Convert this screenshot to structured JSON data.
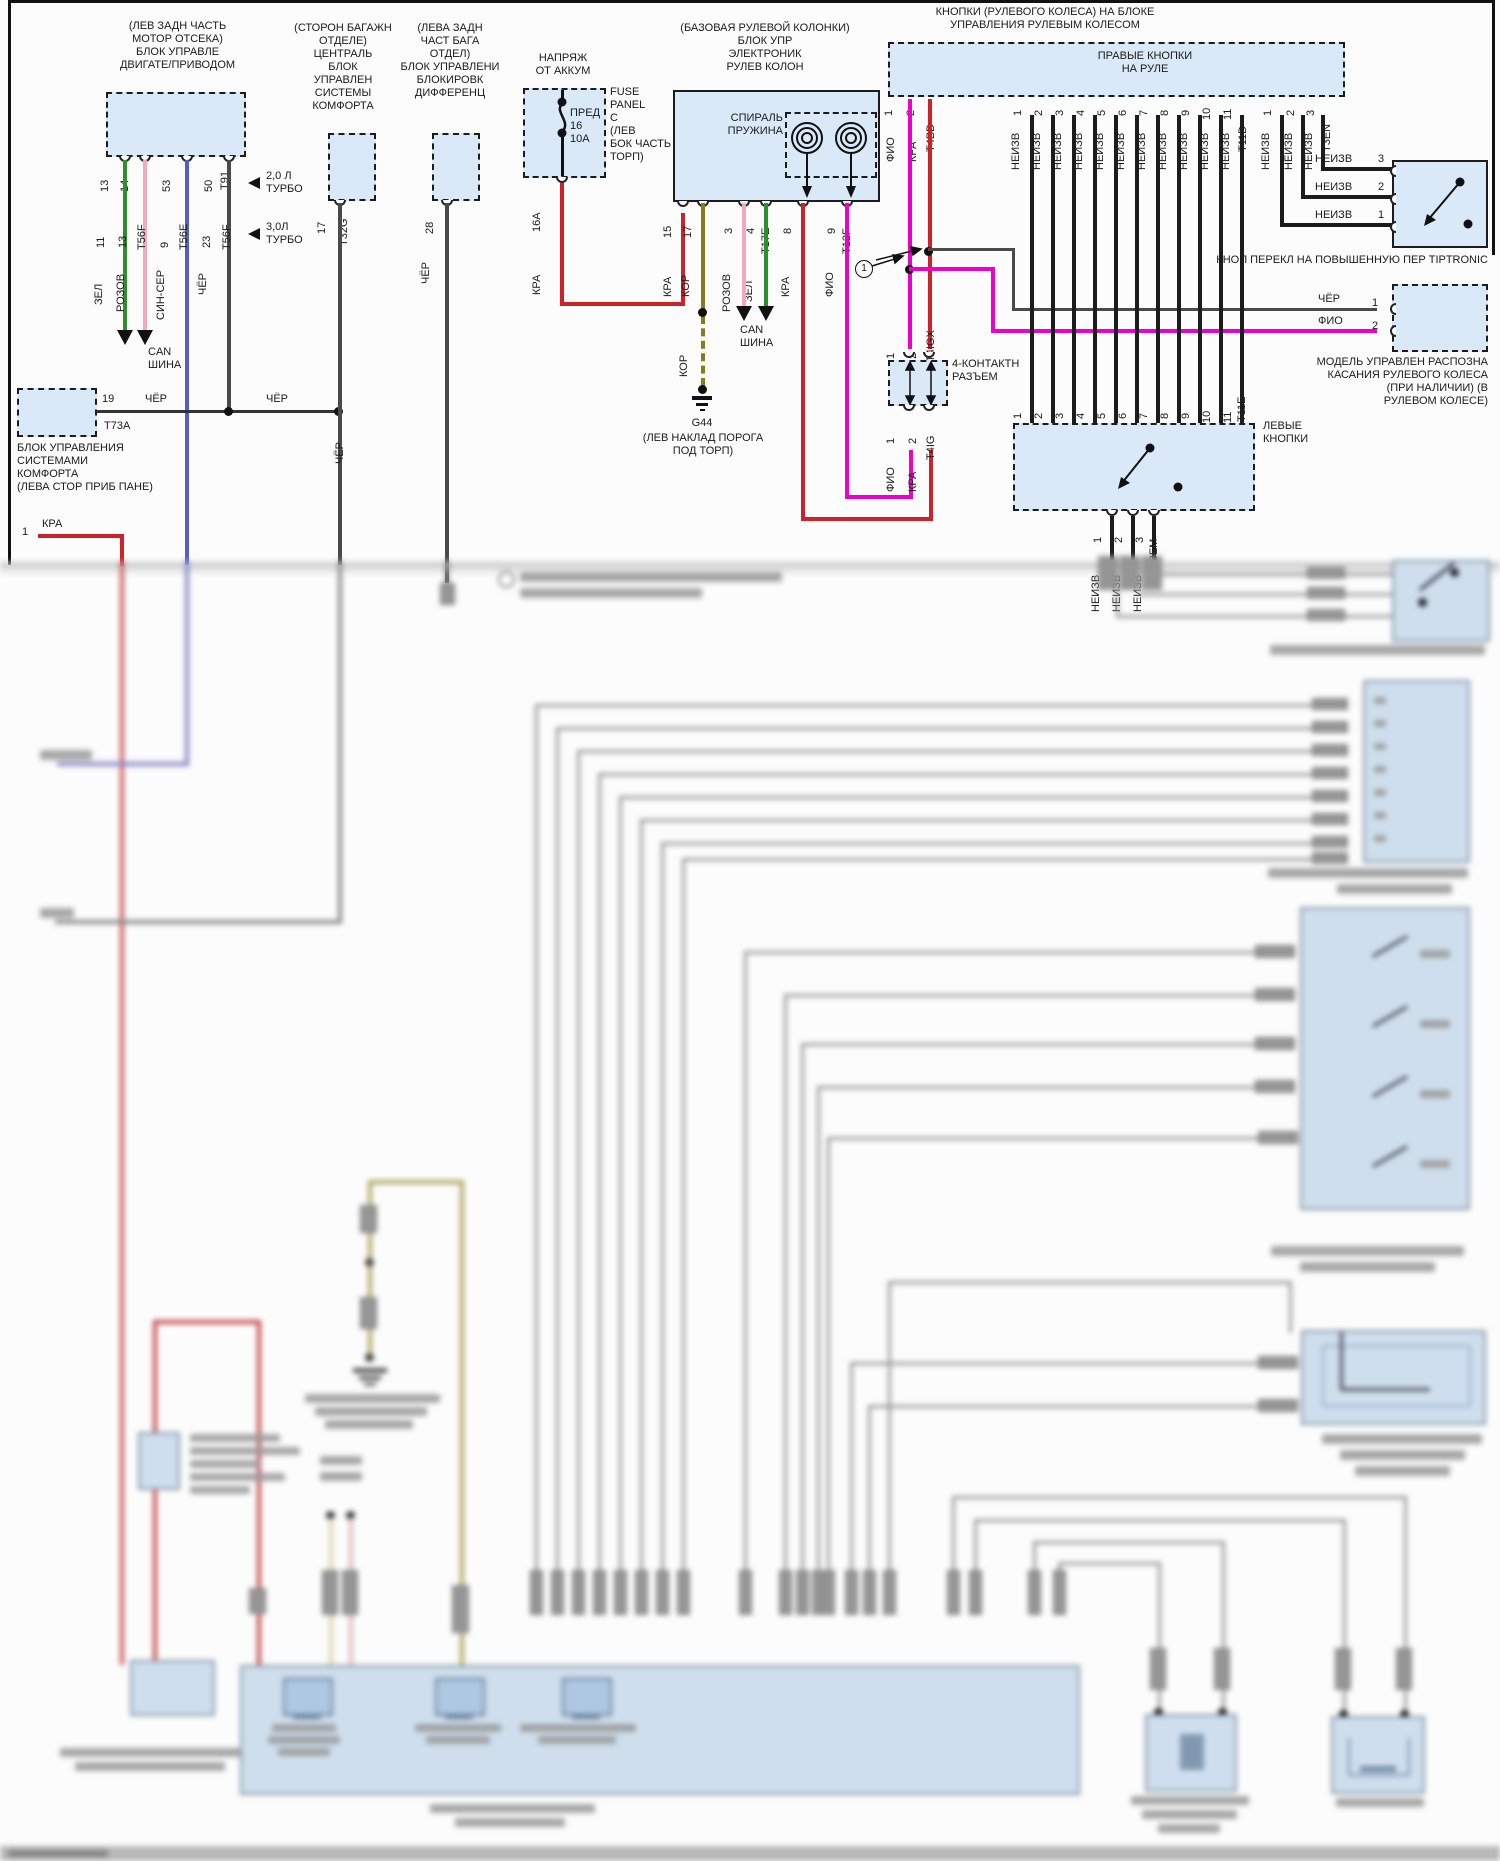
{
  "page": {
    "splice_symbol": "1"
  },
  "ecm": {
    "location": "(ЛЕВ ЗАДН ЧАСТЬ\nМОТОР ОТСЕКА)\nБЛОК УПРАВЛЕ\nДВИГАТЕ/ПРИВОДОМ",
    "pins": [
      "13",
      "14",
      "53",
      "50"
    ],
    "conn_top": "T91",
    "mid": [
      "11",
      "13",
      "T56F",
      "9",
      "T56E",
      "23",
      "T56F"
    ],
    "colors": [
      "ЗЕЛ",
      "РОЗОВ",
      "СИН-СЕР",
      "ЧЁР"
    ],
    "engine1": "2,0 Л\nТУРБО",
    "engine2": "3,0Л\nТУРБО",
    "can": "CAN\nШИНА"
  },
  "t73a": {
    "pin": "19",
    "wire1": "ЧЁР",
    "wire2": "ЧЁР",
    "conn": "T73A",
    "caption": "БЛОК УПРАВЛЕНИЯ\nСИСТЕМАМИ\nКОМФОРТА\n(ЛЕВА СТОР ПРИБ ПАНЕ)",
    "start_pin": "1",
    "start_wire": "КРА"
  },
  "ccm": {
    "location": "(СТОРОН БАГАЖН\nОТДЕЛЕ)\nЦЕНТРАЛЬ\nБЛОК\nУПРАВЛЕН\nСИСТЕМЫ\nКОМФОРТА",
    "pin": "17",
    "conn": "T32G",
    "wire": "ЧЁР"
  },
  "diffm": {
    "location": "(ЛЕВА ЗАДН\nЧАСТ БАГА\nОТДЕЛ)\nБЛОК УПРАВЛЕНИ\nБЛОКИРОВК\nДИФФЕРЕНЦ",
    "pin": "28",
    "wire": "ЧЁР"
  },
  "fuse": {
    "title": "НАПРЯЖ\nОТ АККУМ",
    "body": "ПРЕД\n16\n10А",
    "side": "FUSE\nPANEL\nC\n(ЛЕВ\nБОК ЧАСТЬ\nТОРП)",
    "pin": "16А",
    "wire": "КРА"
  },
  "column": {
    "location": "(БАЗОВАЯ РУЛЕВОЙ КОЛОНКИ)\nБЛОК УПР\nЭЛЕКТРОНИК\nРУЛЕВ КОЛОН",
    "spiral": "СПИРАЛЬ\nПРУЖИНА",
    "pin15": "15",
    "w15": "КРА",
    "pin17": "17",
    "w17": "КОР",
    "pin3": "3",
    "w3": "РОЗОВ",
    "pin4": "4",
    "w4": "ЗЕЛ",
    "t17e": "T17E",
    "pin8": "8",
    "w8": "КРА",
    "pin9": "9",
    "w9": "ФИО",
    "t12f": "T12F",
    "kor2": "КОР",
    "g44": "G44",
    "g44loc": "(ЛЕВ НАКЛАД ПОРОГА\nПОД ТОРП)",
    "can": "CAN\nШИНА"
  },
  "wheel": {
    "header": "КНОПКИ (РУЛЕВОГО КОЛЕСА) НА БЛОКЕ\nУПРАВЛЕНИЯ РУЛЕВЫМ КОЛЕСОМ",
    "right_label": "ПРАВЫЕ КНОПКИ\nНА РУЛЕ",
    "p1": "1",
    "w1": "ФИО",
    "p2": "2",
    "w2": "КРА",
    "t4bd": "T4BD",
    "t11d_pins": [
      "1",
      "2",
      "3",
      "4",
      "5",
      "6",
      "7",
      "8",
      "9",
      "10",
      "11"
    ],
    "t11d": "T11D",
    "unk": "НЕИЗВ",
    "t3en_pins": [
      "1",
      "2",
      "3"
    ],
    "t3en": "T3EN",
    "left_label": "ЛЕВЫЕ\nКНОПКИ",
    "t11e": "T11E",
    "t3em_pins": [
      "1",
      "2",
      "3"
    ],
    "t3em": "T3EM"
  },
  "tiptronic": {
    "label": "КНОП ПЕРЕКЛ НА ПОВЫШЕННУЮ ПЕР TIPTRONIC",
    "rows": [
      {
        "w": "НЕИЗВ",
        "p": "3"
      },
      {
        "w": "НЕИЗВ",
        "p": "2"
      },
      {
        "w": "НЕИЗВ",
        "p": "1"
      }
    ]
  },
  "touch": {
    "w1": "ЧЁР",
    "p1": "1",
    "w2": "ФИО",
    "p2": "2",
    "caption": "МОДЕЛЬ УПРАВЛЕН РАСПОЗНА\nКАСАНИЯ РУЛЕВОГО КОЛЕСА\n(ПРИ НАЛИЧИИ) (В\nРУЛЕВОМ КОЛЕСЕ)"
  },
  "conn4": {
    "title": "4-КОНТАКТН\nРАЗЪЕМ",
    "top": {
      "p1": "1",
      "w1": "ФИО",
      "p2": "2",
      "w2": "КРА",
      "conn": "T4IGX"
    },
    "bottom": {
      "p1": "1",
      "w1": "ФИО",
      "p2": "2",
      "w2": "КРА",
      "conn": "T4IG"
    }
  },
  "colors": {
    "red": "#cc2229",
    "magenta": "#ee00cc",
    "green": "#2e8f2e",
    "pink": "#f2a8c0",
    "olive": "#8a7a1e",
    "blue": "#5b5bc8",
    "gray": "#7a7a7a",
    "black": "#1c1c1c",
    "box_fill": "#d9e9f8"
  }
}
